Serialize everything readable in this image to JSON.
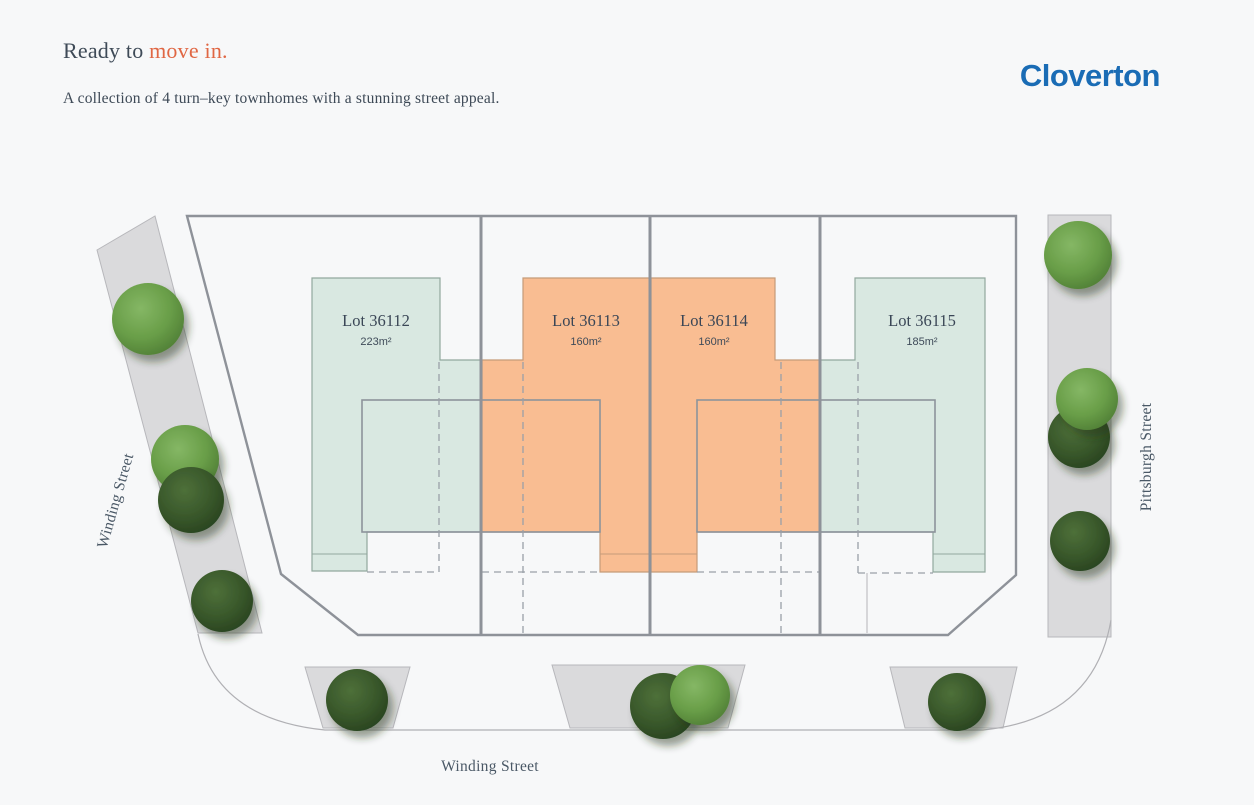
{
  "header": {
    "title_prefix": "Ready to ",
    "title_highlight": "move in.",
    "subtitle": "A collection of 4 turn–key townhomes with a stunning street appeal.",
    "brand": "Cloverton"
  },
  "colors": {
    "accent_orange": "#e06744",
    "brand_blue": "#1a6cb5",
    "lot_green": "#d9e8e1",
    "lot_orange": "#f9bd92",
    "plan_outline": "#8e9299",
    "street_gray": "#dadadc"
  },
  "site_plan": {
    "lots": [
      {
        "name": "Lot 36112",
        "area": "223m²",
        "fill": "#d9e8e1"
      },
      {
        "name": "Lot 36113",
        "area": "160m²",
        "fill": "#f9bd92"
      },
      {
        "name": "Lot 36114",
        "area": "160m²",
        "fill": "#f9bd92"
      },
      {
        "name": "Lot 36115",
        "area": "185m²",
        "fill": "#d9e8e1"
      }
    ],
    "streets": [
      {
        "name": "Winding Street",
        "position": "left"
      },
      {
        "name": "Pittsburgh Street",
        "position": "right"
      },
      {
        "name": "Winding Street",
        "position": "bottom"
      }
    ]
  }
}
